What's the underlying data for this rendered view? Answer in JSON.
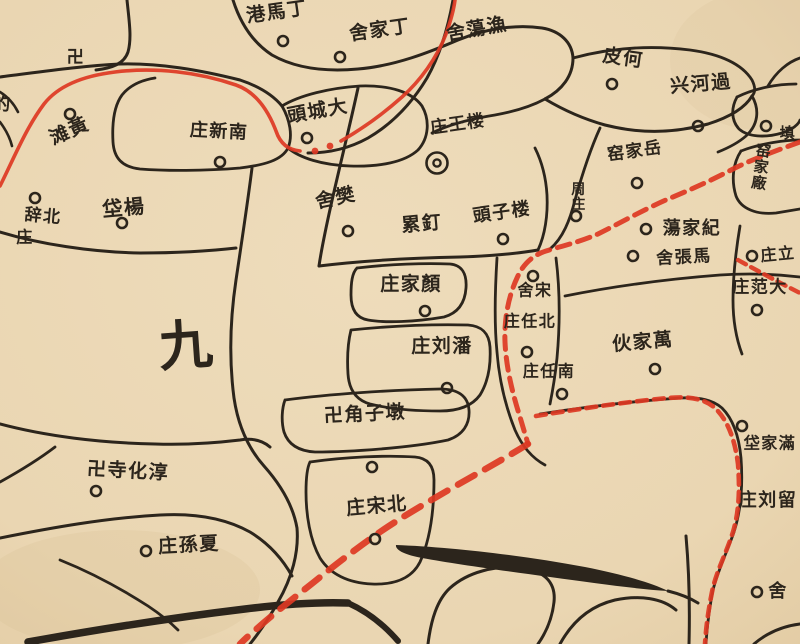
{
  "map": {
    "description": "Historical Chinese county map sheet, hand-drawn road-cell network with village name labels (read right-to-left), village circles, temple swastika marks, red travel route and red dashed district boundaries",
    "paper_color": "#ecd9b6",
    "paper_edge_color": "#e0c99f",
    "ink_color": "#2c251c",
    "red_color": "#dd3823",
    "district_numeral": {
      "text": "九",
      "x": 186,
      "y": 350,
      "size": 54,
      "rot": -4
    },
    "labels": [
      {
        "text": "港馬丁",
        "x": 277,
        "y": 13,
        "size": 19,
        "rot": -8
      },
      {
        "text": "舍家丁",
        "x": 380,
        "y": 31,
        "size": 19,
        "rot": -8
      },
      {
        "text": "舍蕩漁",
        "x": 477,
        "y": 30,
        "size": 19,
        "rot": -10
      },
      {
        "text": "皮何",
        "x": 623,
        "y": 59,
        "size": 19,
        "rot": 8
      },
      {
        "text": "兴河過",
        "x": 701,
        "y": 85,
        "size": 19,
        "rot": -5
      },
      {
        "text": "頭城大",
        "x": 318,
        "y": 112,
        "size": 19,
        "rot": -10
      },
      {
        "text": "庄新南",
        "x": 219,
        "y": 132,
        "size": 18,
        "rot": 3
      },
      {
        "text": "滩黃",
        "x": 70,
        "y": 132,
        "size": 19,
        "rot": -24
      },
      {
        "text": "辞北",
        "x": 43,
        "y": 217,
        "size": 17,
        "rot": 5
      },
      {
        "text": "庄",
        "x": 25,
        "y": 238,
        "size": 16,
        "rot": 0
      },
      {
        "text": "垈楊",
        "x": 124,
        "y": 209,
        "size": 20,
        "rot": -5
      },
      {
        "text": "舍樊",
        "x": 336,
        "y": 199,
        "size": 19,
        "rot": -12
      },
      {
        "text": "累釘",
        "x": 422,
        "y": 225,
        "size": 19,
        "rot": -5
      },
      {
        "text": "頭子楼",
        "x": 502,
        "y": 213,
        "size": 18,
        "rot": -8
      },
      {
        "text": "庄王楼",
        "x": 458,
        "y": 125,
        "size": 17,
        "rot": -8
      },
      {
        "text": "窑家岳",
        "x": 635,
        "y": 152,
        "size": 17,
        "rot": -8
      },
      {
        "text": "周庄",
        "x": 579,
        "y": 190,
        "size": 14,
        "rot": 0,
        "vertical": true
      },
      {
        "text": "窑家廠",
        "x": 764,
        "y": 152,
        "size": 15,
        "rot": 8,
        "vertical": true
      },
      {
        "text": "填",
        "x": 788,
        "y": 134,
        "size": 15,
        "rot": 0
      },
      {
        "text": "蕩家紀",
        "x": 692,
        "y": 229,
        "size": 18,
        "rot": 0
      },
      {
        "text": "舍張馬",
        "x": 684,
        "y": 258,
        "size": 17,
        "rot": -3
      },
      {
        "text": "庄范大",
        "x": 760,
        "y": 288,
        "size": 17,
        "rot": 0
      },
      {
        "text": "庄立",
        "x": 778,
        "y": 255,
        "size": 16,
        "rot": -5
      },
      {
        "text": "舍宋",
        "x": 535,
        "y": 291,
        "size": 16,
        "rot": 0
      },
      {
        "text": "庄任北",
        "x": 530,
        "y": 322,
        "size": 16,
        "rot": 0
      },
      {
        "text": "庄任南",
        "x": 549,
        "y": 372,
        "size": 16,
        "rot": 0
      },
      {
        "text": "庄家顏",
        "x": 411,
        "y": 285,
        "size": 19,
        "rot": 0
      },
      {
        "text": "庄刘潘",
        "x": 442,
        "y": 347,
        "size": 19,
        "rot": 0
      },
      {
        "text": "卍角子墩",
        "x": 365,
        "y": 415,
        "size": 19,
        "rot": -3
      },
      {
        "text": "庄宋北",
        "x": 377,
        "y": 507,
        "size": 19,
        "rot": -5
      },
      {
        "text": "卍寺化淳",
        "x": 128,
        "y": 472,
        "size": 19,
        "rot": 3
      },
      {
        "text": "庄孫夏",
        "x": 189,
        "y": 546,
        "size": 19,
        "rot": -3
      },
      {
        "text": "伙家萬",
        "x": 643,
        "y": 343,
        "size": 19,
        "rot": -5
      },
      {
        "text": "庄刘留",
        "x": 768,
        "y": 501,
        "size": 18,
        "rot": 0
      },
      {
        "text": "垈家滿",
        "x": 770,
        "y": 444,
        "size": 16,
        "rot": 0
      },
      {
        "text": "舍",
        "x": 778,
        "y": 592,
        "size": 18,
        "rot": 0
      },
      {
        "text": "的",
        "x": 2,
        "y": 105,
        "size": 18,
        "rot": 0
      },
      {
        "text": "卍",
        "x": 76,
        "y": 58,
        "size": 17,
        "rot": 0
      }
    ],
    "village_circles": [
      [
        283,
        41
      ],
      [
        340,
        57
      ],
      [
        612,
        84
      ],
      [
        698,
        126
      ],
      [
        307,
        138
      ],
      [
        220,
        162
      ],
      [
        70,
        114
      ],
      [
        348,
        231
      ],
      [
        503,
        239
      ],
      [
        637,
        183
      ],
      [
        576,
        216
      ],
      [
        766,
        126
      ],
      [
        646,
        229
      ],
      [
        633,
        256
      ],
      [
        757,
        310
      ],
      [
        752,
        256
      ],
      [
        533,
        276
      ],
      [
        527,
        352
      ],
      [
        562,
        394
      ],
      [
        425,
        311
      ],
      [
        447,
        388
      ],
      [
        372,
        467
      ],
      [
        375,
        539
      ],
      [
        96,
        491
      ],
      [
        146,
        551
      ],
      [
        655,
        369
      ],
      [
        742,
        426
      ],
      [
        757,
        592
      ],
      [
        35,
        198
      ],
      [
        122,
        223
      ]
    ],
    "town_double_circle": {
      "x": 437,
      "y": 163
    },
    "roads": [
      {
        "d": "M127,0 C129,20 132,38 128,52 C124,64 112,68 96,70",
        "w": 3
      },
      {
        "d": "M0,77 C40,72 80,66 120,64 C160,63 200,70 240,80 C258,86 272,94 282,106",
        "w": 3
      },
      {
        "d": "M282,106 C290,120 293,136 288,148 C282,160 265,165 240,168 C205,171 165,171 140,169 C122,167 114,158 113,142 C112,124 114,106 122,95 C130,85 142,80 155,78",
        "w": 2.8
      },
      {
        "d": "M282,106 C300,95 330,88 360,86 C390,85 412,92 422,106 C430,120 429,138 418,150 C405,162 380,167 350,166 C322,165 300,158 288,148",
        "w": 2.8
      },
      {
        "d": "M453,0 C448,28 440,55 427,78 C412,103 392,124 368,138 C350,148 330,153 308,153",
        "w": 3
      },
      {
        "d": "M233,0 C240,22 252,42 272,55 C295,68 325,72 358,69 C395,66 430,52 458,40 C485,29 515,24 542,28 C560,31 572,42 573,58 C573,76 562,90 545,99",
        "w": 3
      },
      {
        "d": "M545,99 C530,107 512,112 495,115 C470,119 448,125 432,133",
        "w": 2.8
      },
      {
        "d": "M545,99 C560,108 580,118 605,125 C640,134 675,133 708,124 C730,117 745,108 752,96",
        "w": 3
      },
      {
        "d": "M573,58 C610,48 650,45 690,50 C720,54 742,64 752,80 C756,88 755,93 752,96",
        "w": 2.8
      },
      {
        "d": "M600,128 C590,150 582,175 575,200 C570,220 563,238 550,249",
        "w": 2.8
      },
      {
        "d": "M752,96 C760,110 758,125 746,136 C738,143 728,148 718,152",
        "w": 2.8
      },
      {
        "d": "M737,97 C755,88 778,84 796,84",
        "w": 2.8
      },
      {
        "d": "M737,97 C731,108 731,120 739,129 C748,137 765,138 782,133 C792,130 799,124 800,120",
        "w": 2.8
      },
      {
        "d": "M741,151 C762,143 786,140 800,140",
        "w": 2.8
      },
      {
        "d": "M741,151 C733,163 731,180 736,196 C741,209 757,215 776,213 L800,209",
        "w": 2.8
      },
      {
        "d": "M768,86 C776,72 788,62 800,58",
        "w": 2.8
      },
      {
        "d": "M358,88 C350,125 340,165 331,205 C325,232 321,252 319,266",
        "w": 3
      },
      {
        "d": "M319,266 C360,261 410,258 460,257 C490,256 515,254 538,250",
        "w": 3
      },
      {
        "d": "M538,250 C545,235 548,215 547,195 C546,178 542,162 535,148",
        "w": 2.8
      },
      {
        "d": "M252,168 C248,200 242,240 236,280 C230,320 229,360 234,398 C238,425 248,448 264,466 C280,484 293,505 297,528 C299,552 292,578 278,602 C268,620 258,634 250,644",
        "w": 3
      },
      {
        "d": "M0,232 C40,244 90,252 140,253 C175,253 210,251 236,248",
        "w": 3
      },
      {
        "d": "M0,424 C45,436 100,443 155,444 C185,445 215,443 240,440 C252,438 262,440 270,447",
        "w": 3
      },
      {
        "d": "M55,447 C38,460 18,472 0,482",
        "w": 2.8
      },
      {
        "d": "M0,538 C50,528 105,518 160,515 C195,513 225,518 250,532 C268,543 282,558 292,576",
        "w": 3
      },
      {
        "d": "M60,560 C90,572 120,588 148,606 C160,614 170,622 178,630",
        "w": 2.8
      },
      {
        "d": "M357,268 C390,264 425,263 450,264 C462,265 467,274 466,288 C465,303 458,313 444,317 C415,322 385,323 368,320 C356,318 351,309 351,295 C351,283 352,273 357,268",
        "w": 2.8
      },
      {
        "d": "M351,330 C390,326 430,324 468,325 C482,326 489,333 490,347 C491,365 488,382 480,395 C472,406 458,411 440,411 C415,411 390,409 370,404 C356,400 349,390 348,374 C347,358 348,342 351,330",
        "w": 2.8
      },
      {
        "d": "M285,400 C330,394 390,390 440,389 C458,389 468,396 469,410 C470,424 463,435 448,440 C410,448 350,452 315,452 C298,451 288,444 284,432 C281,421 282,408 285,400",
        "w": 2.8
      },
      {
        "d": "M310,462 C345,457 385,455 415,457 C428,458 434,466 434,480 C434,510 430,540 420,562 C412,578 395,585 372,584 C348,583 330,574 320,558 C310,540 306,515 306,492 C306,478 307,468 310,462",
        "w": 2.8
      },
      {
        "d": "M497,258 C495,290 494,322 497,352 C499,378 505,405 515,430 C522,446 532,458 545,465",
        "w": 2.8
      },
      {
        "d": "M556,258 C560,290 560,325 557,358 C555,378 552,394 550,404",
        "w": 2.8
      },
      {
        "d": "M565,296 C615,286 668,279 720,275 C750,273 775,274 800,277",
        "w": 2.8
      },
      {
        "d": "M540,414 C585,407 635,401 680,398 C700,397 713,400 722,408 C733,419 739,436 741,458 C743,485 741,510 734,532 C727,552 718,570 713,590 C709,610 707,627 706,644",
        "w": 2.8
      },
      {
        "d": "M740,226 C736,250 733,275 733,300 C733,320 736,338 742,354",
        "w": 2.8
      },
      {
        "d": "M686,536 C689,570 690,605 689,644",
        "w": 3
      },
      {
        "d": "M428,644 C431,620 437,600 450,588 C468,572 495,565 522,568 C545,571 556,583 554,602 C552,620 545,634 538,644",
        "w": 3
      },
      {
        "d": "M560,644 C572,622 590,606 615,600 C640,595 662,598 676,610",
        "w": 3
      },
      {
        "d": "M754,644 C768,632 784,626 800,624",
        "w": 3
      },
      {
        "d": "M0,92 C8,97 14,104 18,112",
        "w": 2.6
      },
      {
        "d": "M0,122 C6,130 10,138 12,146",
        "w": 2.6
      },
      {
        "d": "M28,642 C95,630 170,618 245,609 C285,604 320,602 348,603",
        "w": 7.5
      },
      {
        "d": "M348,603 C368,612 385,626 398,641",
        "w": 6
      },
      {
        "d": "M668,591 C680,594 690,598 698,603",
        "w": 3
      }
    ],
    "filled_shapes": [
      {
        "d": "M396,545 C450,547 520,555 585,567 C620,574 650,582 668,591 C635,589 595,583 550,577 C505,571 455,564 422,558 C405,555 395,550 396,545 Z"
      }
    ],
    "red_routes": [
      {
        "d": "M0,186 C14,158 26,128 44,104 C58,86 82,76 115,72 C155,67 198,72 236,85 C256,92 268,110 276,131 C280,143 288,150 300,151",
        "w": 3.6,
        "dash": ""
      },
      {
        "d": "M341,141 C362,129 384,113 402,97 C420,81 437,58 446,34 C451,20 454,8 455,0",
        "w": 3.6,
        "dash": ""
      },
      {
        "d": "M800,142 C778,150 753,159 735,168 C712,180 690,190 668,199 C645,209 620,223 598,234 C577,243 558,247 546,251 C533,255 523,264 517,278 C509,295 504,318 505,342 C506,366 512,392 520,417 C524,431 527,440 528,444",
        "w": 5,
        "dash": "13 8"
      },
      {
        "d": "M528,444 C504,459 478,473 452,488 C426,503 402,517 380,532 C357,548 335,565 314,582 C295,597 272,615 252,633 C247,637 243,641 240,644",
        "w": 6.5,
        "dash": "19 12"
      },
      {
        "d": "M536,416 C578,409 625,402 668,398 C690,396 706,399 716,409 C728,421 735,440 738,464 C740,490 739,512 733,532 C726,554 716,572 712,592 C708,612 706,628 705,644",
        "w": 4.6,
        "dash": "10 7"
      },
      {
        "d": "M738,260 C758,271 778,282 800,293",
        "w": 4.4,
        "dash": "9 6"
      }
    ],
    "red_dots": [
      [
        315,
        151
      ],
      [
        330,
        146
      ]
    ]
  }
}
